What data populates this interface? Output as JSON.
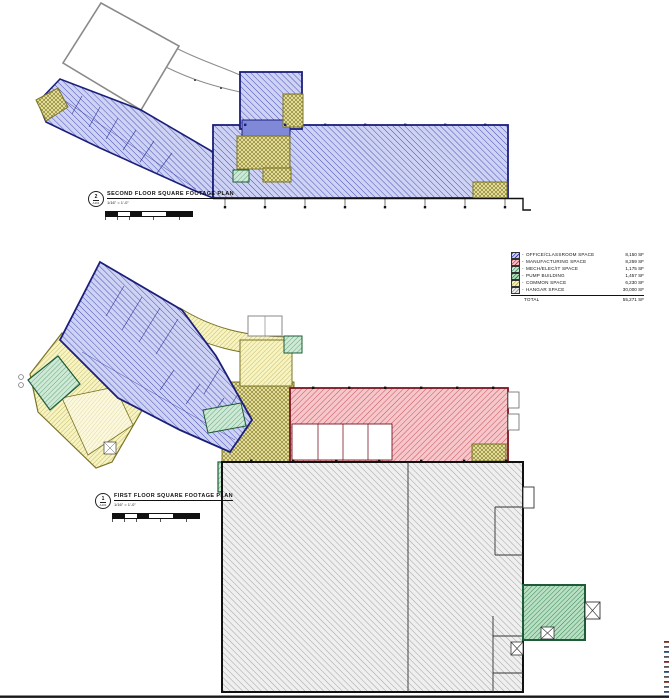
{
  "titles": {
    "second_floor": {
      "bubble_number": "2",
      "bubble_ref": "A101",
      "title": "SECOND FLOOR SQUARE FOOTAGE PLAN",
      "scale": "1/16\" = 1'-0\""
    },
    "first_floor": {
      "bubble_number": "1",
      "bubble_ref": "A101",
      "title": "FIRST FLOOR SQUARE FOOTAGE PLAN",
      "scale": "1/16\" = 1'-0\""
    }
  },
  "legend": {
    "prefix": "-",
    "rows": [
      {
        "label": "OFFICE/CLASSROOM SPACE",
        "value": "8,150 SF",
        "fill": "#ced3f4",
        "hatch": "#3c42b0"
      },
      {
        "label": "MANUFACTURING SPACE",
        "value": "8,259 SF",
        "fill": "#f6c7ca",
        "hatch": "#c2434f"
      },
      {
        "label": "MECH/ELEC/IT SPACE",
        "value": "1,175 SF",
        "fill": "#cfe9d7",
        "hatch": "#4a9465"
      },
      {
        "label": "PUMP BUILDING",
        "value": "1,457 SF",
        "fill": "#b9e0c4",
        "hatch": "#35854f"
      },
      {
        "label": "COMMON SPACE",
        "value": "6,230 SF",
        "fill": "#f8f4c2",
        "hatch": "#b9b05b"
      },
      {
        "label": "HANGAR SPACE",
        "value": "30,000 SF",
        "fill": "#efefef",
        "hatch": "#999999"
      }
    ],
    "total_label": "TOTAL",
    "total_value": "55,271 SF"
  }
}
